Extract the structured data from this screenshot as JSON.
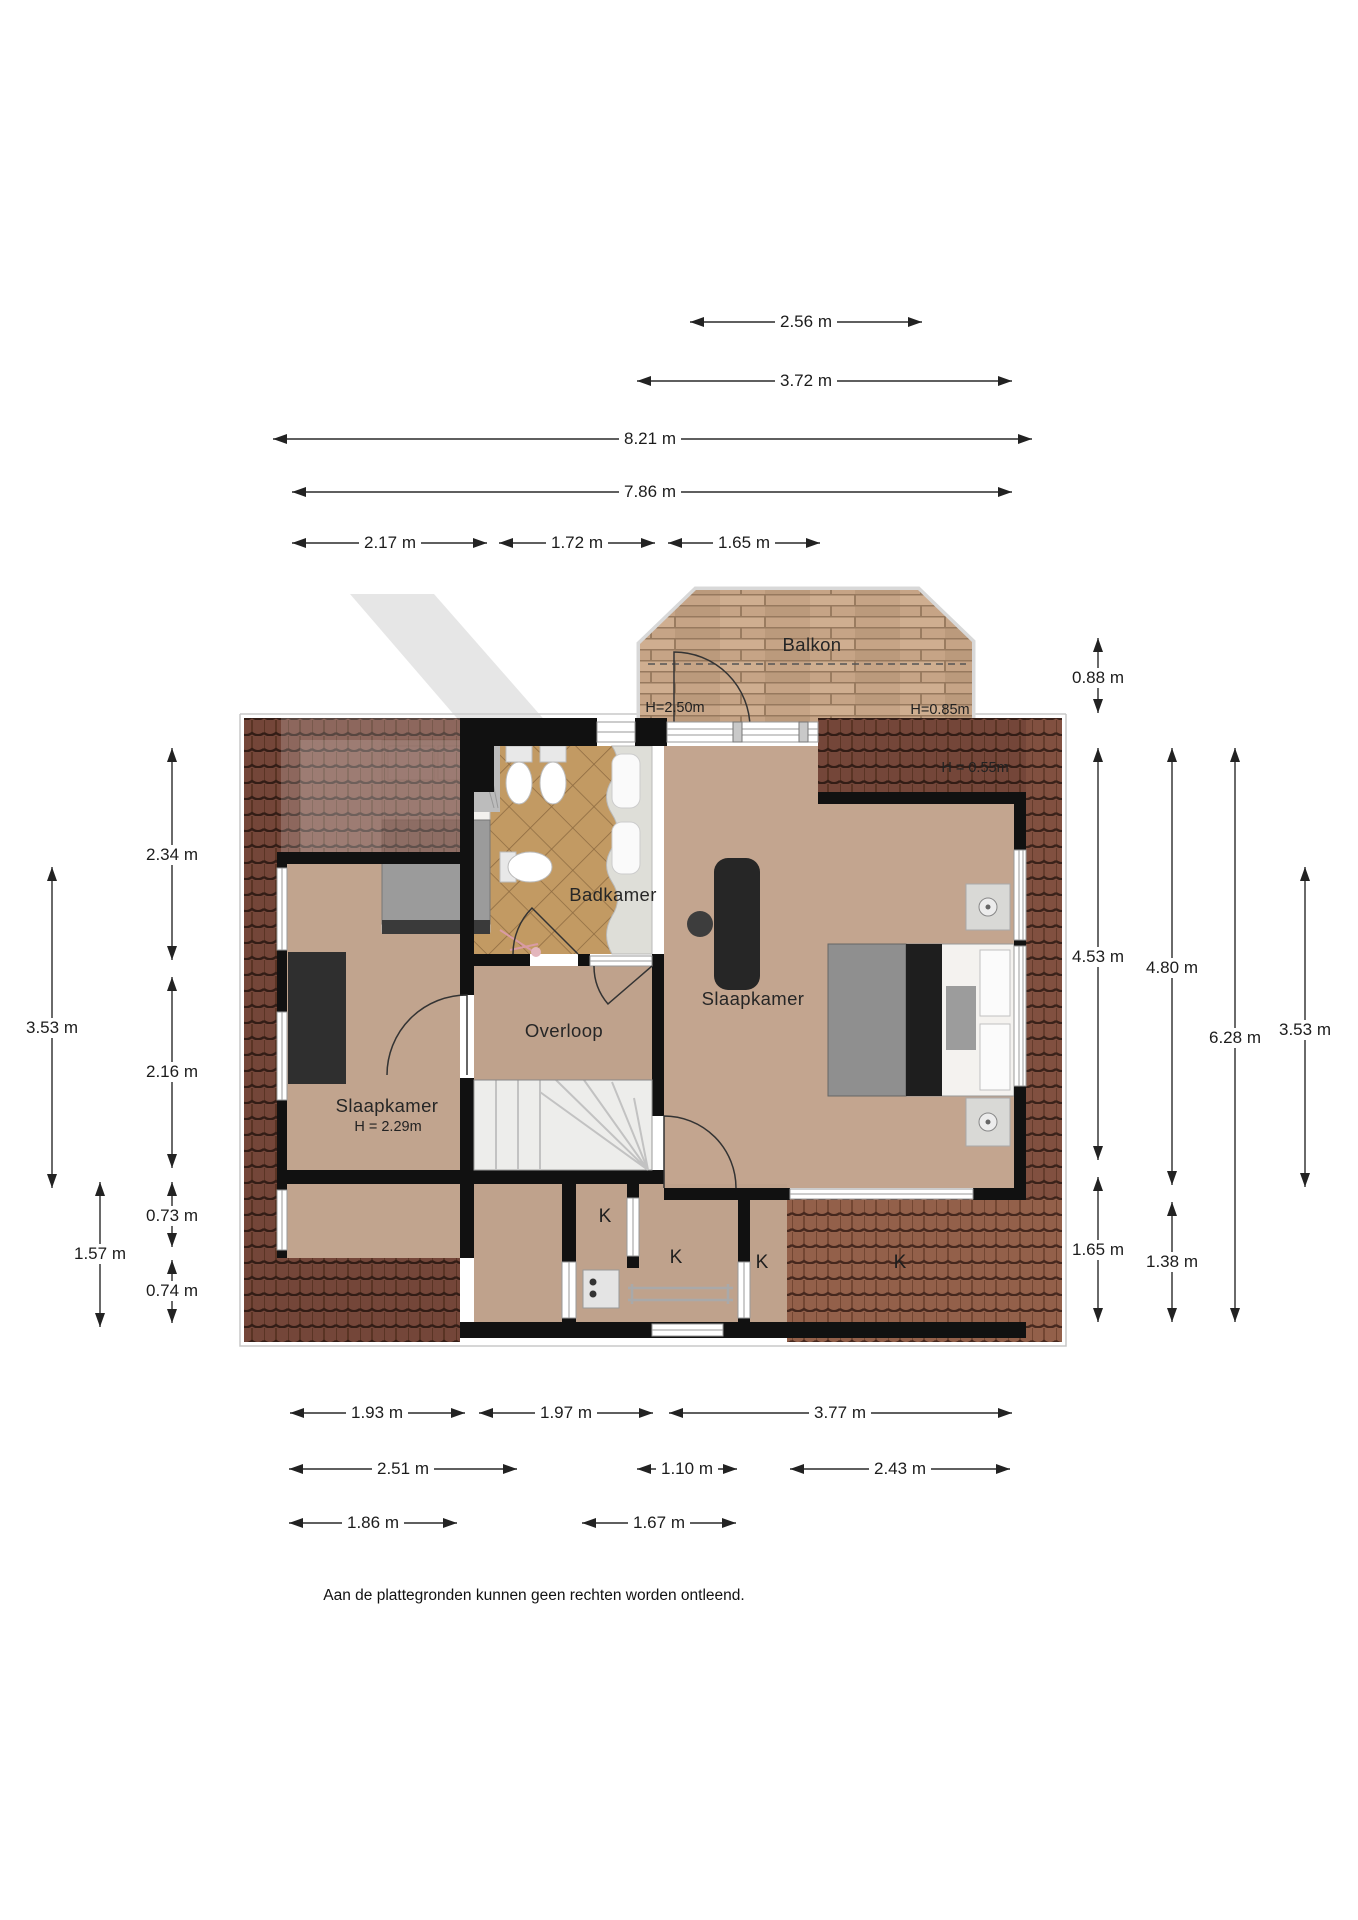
{
  "rooms": {
    "balkon": "Balkon",
    "badkamer": "Badkamer",
    "slaapkamer_left": "Slaapkamer",
    "slaapkamer_left_height": "H = 2.29m",
    "slaapkamer_right": "Slaapkamer",
    "overloop": "Overloop"
  },
  "height_labels": {
    "balcony_door": "H=2.50m",
    "balcony_right": "H=0.85m",
    "roof_right": "H = 0.55m"
  },
  "closets": [
    {
      "label": "K"
    },
    {
      "label": "K"
    },
    {
      "label": "K"
    },
    {
      "label": "K"
    }
  ],
  "dimensions": {
    "top": [
      {
        "label": "2.56 m"
      },
      {
        "label": "3.72 m"
      },
      {
        "label": "8.21 m"
      },
      {
        "label": "7.86 m"
      },
      {
        "label": "2.17 m"
      },
      {
        "label": "1.72 m"
      },
      {
        "label": "1.65 m"
      }
    ],
    "bottom": [
      {
        "label": "1.93 m"
      },
      {
        "label": "1.97 m"
      },
      {
        "label": "3.77 m"
      },
      {
        "label": "2.51 m"
      },
      {
        "label": "1.10 m"
      },
      {
        "label": "2.43 m"
      },
      {
        "label": "1.86 m"
      },
      {
        "label": "1.67 m"
      }
    ],
    "left": [
      {
        "label": "2.34 m"
      },
      {
        "label": "3.53 m"
      },
      {
        "label": "2.16 m"
      },
      {
        "label": "0.73 m"
      },
      {
        "label": "1.57 m"
      },
      {
        "label": "0.74 m"
      }
    ],
    "right": [
      {
        "label": "0.88 m"
      },
      {
        "label": "4.53 m"
      },
      {
        "label": "4.80 m"
      },
      {
        "label": "6.28 m"
      },
      {
        "label": "3.53 m"
      },
      {
        "label": "1.65 m"
      },
      {
        "label": "1.38 m"
      }
    ]
  },
  "footer": {
    "disclaimer": "Aan de plattegronden kunnen geen rechten worden ontleend."
  },
  "colors": {
    "roof_tile_dark": "#744639",
    "roof_tile_mid": "#815040",
    "roof_tile_light": "#93604a",
    "balcony_wood": "#c6a486",
    "floor": "#c3a58f",
    "bathroom_floor": "#c29a63",
    "wall": "#111111",
    "dimension_line": "#222222"
  }
}
